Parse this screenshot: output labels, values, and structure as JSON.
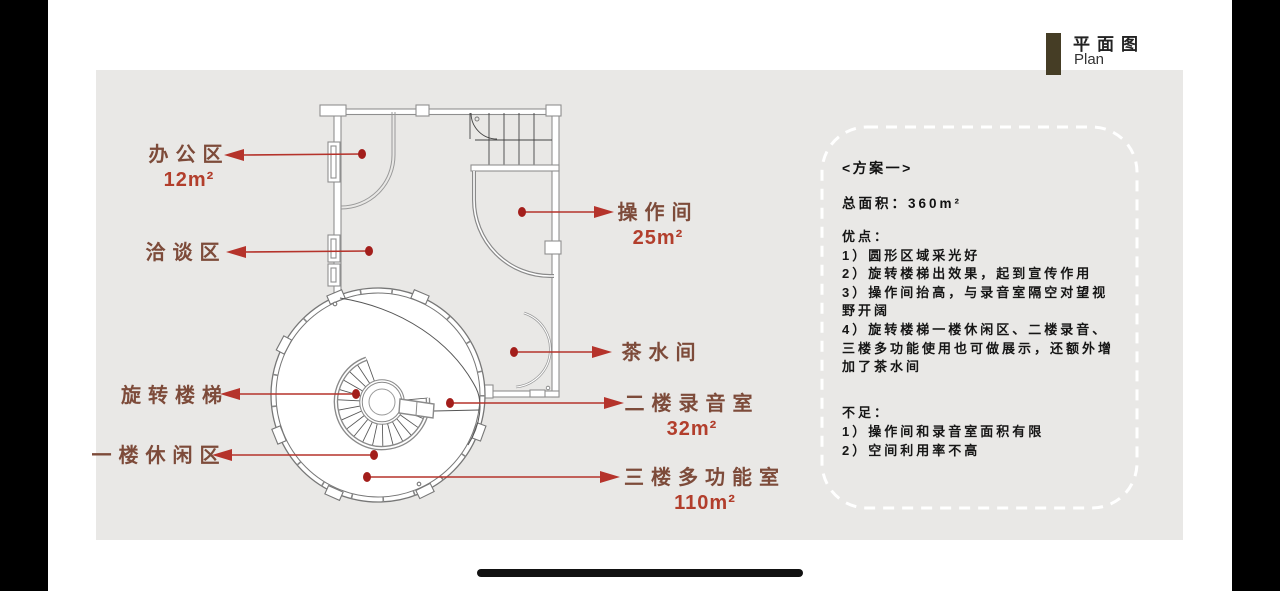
{
  "header": {
    "title_cn": "平面图",
    "title_en": "Plan"
  },
  "labels": {
    "office": {
      "name": "办公区",
      "area": "12m²"
    },
    "negotiation": {
      "name": "洽谈区"
    },
    "operation": {
      "name": "操作间",
      "area": "25m²"
    },
    "tea": {
      "name": "茶水间"
    },
    "recording": {
      "name": "二楼录音室",
      "area": "32m²"
    },
    "spiral": {
      "name": "旋转楼梯"
    },
    "leisure": {
      "name": "一楼休闲区"
    },
    "multifunction": {
      "name": "三楼多功能室",
      "area": "110m²"
    }
  },
  "scheme": {
    "title": "<方案一>",
    "total_area": "总面积：360m²",
    "pros_heading": "优点：",
    "pros": [
      "1）圆形区域采光好",
      "2）旋转楼梯出效果，起到宣传作用",
      "3）操作间抬高，与录音室隔空对望视野开阔",
      "4）旋转楼梯一楼休闲区、二楼录音、三楼多功能使用也可做展示，还额外增加了茶水间"
    ],
    "cons_heading": "不足：",
    "cons": [
      "1）操作间和录音室面积有限",
      "2）空间利用率不高"
    ]
  },
  "colors": {
    "panel_bg": "#e9e8e6",
    "label_text": "#7d4b3a",
    "area_text": "#b23e2c",
    "arrow": "#b5332b",
    "dot": "#a31e1b",
    "header_bar": "#453d25",
    "wall_gray": "#8f8f8f",
    "dashed_border": "#ffffff"
  }
}
